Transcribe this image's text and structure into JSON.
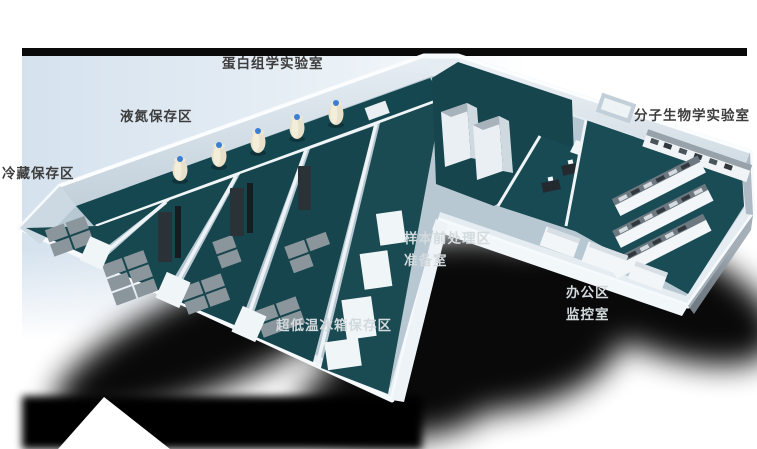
{
  "figure": {
    "kind": "3d-laboratory-floorplan-render"
  },
  "palette": {
    "background": "#ffffff",
    "backdrop_blue": "#d5e2ee",
    "top_bar_black": "#0a0a0a",
    "floor_teal": "#17474f",
    "wall_white": "#f2f6f9",
    "slab_gray": "#e6edf2",
    "freezer_gray": "#8b959c",
    "rack_dark": "#2a3137",
    "tank_body_cream": "#e8e0c8",
    "tank_cap_blue": "#3c7ed2",
    "shadow_black": "#000000",
    "label_dark": "#3d3d3d",
    "label_light": "#d3dadd"
  },
  "labels": [
    {
      "id": "proteomics-lab",
      "text": "蛋白组学实验室",
      "style": "dark"
    },
    {
      "id": "liquid-nitrogen-storage",
      "text": "液氮保存区",
      "style": "dark"
    },
    {
      "id": "cold-storage",
      "text": "冷藏保存区",
      "style": "dark"
    },
    {
      "id": "molecular-biology-lab",
      "text": "分子生物学实验室",
      "style": "dark"
    },
    {
      "id": "sample-pretreatment",
      "text": "样本前处理区",
      "style": "light"
    },
    {
      "id": "preparation-room",
      "text": "准备室",
      "style": "light"
    },
    {
      "id": "office-area",
      "text": "办公区",
      "style": "light"
    },
    {
      "id": "monitoring-room",
      "text": "监控室",
      "style": "light"
    },
    {
      "id": "ulf-freezer-storage",
      "text": "超低温冰箱保存区",
      "style": "light"
    }
  ]
}
